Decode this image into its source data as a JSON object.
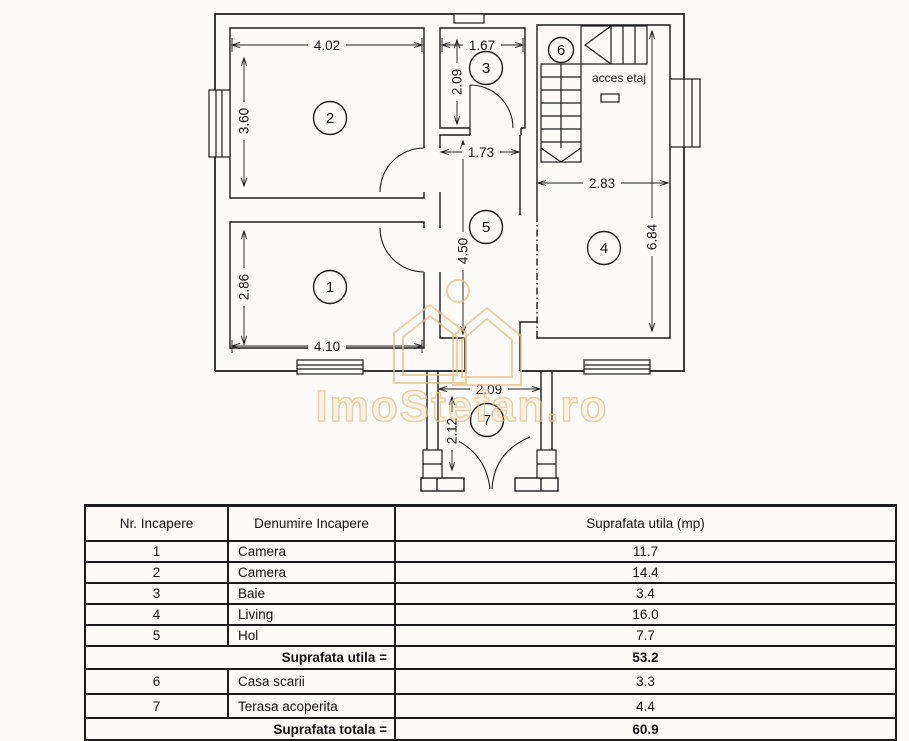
{
  "background_color": "#fcfbf7",
  "line_color": "#1c1c1c",
  "watermark": {
    "text": "ImoStefan.ro",
    "color": "#eabe82"
  },
  "floorplan": {
    "access_label": "acces etaj",
    "rooms": [
      {
        "number": "1"
      },
      {
        "number": "2"
      },
      {
        "number": "3"
      },
      {
        "number": "4"
      },
      {
        "number": "5"
      },
      {
        "number": "6"
      },
      {
        "number": "7"
      }
    ],
    "dimensions": {
      "room2_width": "4.02",
      "room2_height": "3.60",
      "room3_width": "1.67",
      "room3_height": "2.09",
      "hall_width": "1.73",
      "hall_height": "4.50",
      "room4_width": "2.83",
      "room4_height": "6.84",
      "room1_width": "4.10",
      "room1_height": "2.86",
      "terrace_width": "2.09",
      "terrace_height": "2.12"
    }
  },
  "table": {
    "headers": [
      "Nr. Incapere",
      "Denumire Incapere",
      "Suprafata utila (mp)"
    ],
    "rows": [
      {
        "nr": "1",
        "name": "Camera",
        "area": "11.7"
      },
      {
        "nr": "2",
        "name": "Camera",
        "area": "14.4"
      },
      {
        "nr": "3",
        "name": "Baie",
        "area": "3.4"
      },
      {
        "nr": "4",
        "name": "Living",
        "area": "16.0"
      },
      {
        "nr": "5",
        "name": "Hol",
        "area": "7.7"
      }
    ],
    "subtotal_label": "Suprafata utila =",
    "subtotal_value": "53.2",
    "extra_rows": [
      {
        "nr": "6",
        "name": "Casa scarii",
        "area": "3.3"
      },
      {
        "nr": "7",
        "name": "Terasa acoperita",
        "area": "4.4"
      }
    ],
    "total_label": "Suprafata totala =",
    "total_value": "60.9"
  }
}
